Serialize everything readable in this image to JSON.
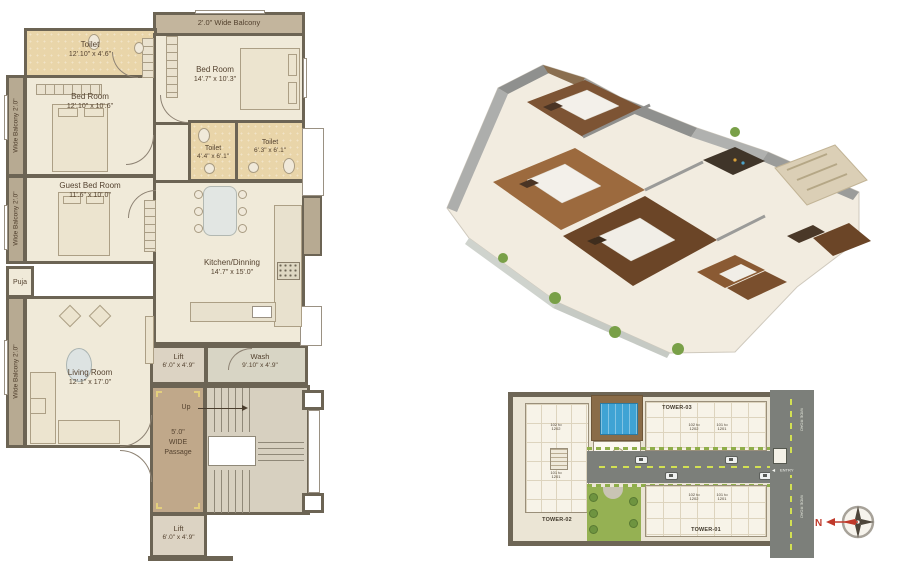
{
  "plan2d": {
    "top_balcony_label": "2'.0\" Wide Balcony",
    "side_balcony_label": "Wide Balcony 2'.0\"",
    "up_label": "Up",
    "rooms": {
      "toilet_top": {
        "name": "Toilet",
        "dims": "12'.10\" x 4'.6\""
      },
      "bedroom_top_right": {
        "name": "Bed Room",
        "dims": "14'.7\" x 10'.3\""
      },
      "bedroom_left": {
        "name": "Bed Room",
        "dims": "12'.10\" x 10'.6\""
      },
      "toilet_small": {
        "name": "Toilet",
        "dims": "4'.4\" x 6'.1\""
      },
      "toilet_mid": {
        "name": "Toilet",
        "dims": "6'.3\" x 6'.1\""
      },
      "guest_bedroom": {
        "name": "Guest Bed Room",
        "dims": "11'.6\" x 10'.0\""
      },
      "kitchen_dining": {
        "name": "Kitchen/Dinning",
        "dims": "14'.7\" x 15'.0\""
      },
      "puja": {
        "name": "Puja"
      },
      "living_room": {
        "name": "Living Room",
        "dims": "12'.1\" x 17'.0\""
      },
      "lift_upper": {
        "name": "Lift",
        "dims": "6'.0\" x 4'.9\""
      },
      "wash": {
        "name": "Wash",
        "dims": "9'.10\" x 4'.9\""
      },
      "passage": {
        "line1": "5'.0\"",
        "line2": "WIDE",
        "line3": "Passage"
      },
      "lift_lower": {
        "name": "Lift",
        "dims": "6'.0\" x 4'.9\""
      }
    }
  },
  "siteplan": {
    "tower1": {
      "label": "TOWER-01",
      "units_a": "102 to 1202",
      "units_b": "101 to 1201"
    },
    "tower2": {
      "label": "TOWER-02",
      "units_a": "102 to 1202",
      "units_b": "101 to 1201"
    },
    "tower3": {
      "label": "TOWER-03",
      "units_a": "102 to 1202",
      "units_b": "101 to 1201"
    },
    "entry_label": "ENTRY",
    "road_label": "WIDE ROAD",
    "compass": {
      "north_label": "N"
    }
  },
  "palette": {
    "wall": "#6c6454",
    "room_cream": "#f0ead9",
    "toilet_tan": "#e9d5a9",
    "balcony_tan": "#b7aa92",
    "passage_brown": "#c0a88a",
    "road_gray": "#7c7f7a",
    "lane_dash": "#d2e052",
    "garden_green": "#95b153",
    "pool_blue": "#3fa3d4",
    "compass_red": "#c0392b"
  }
}
